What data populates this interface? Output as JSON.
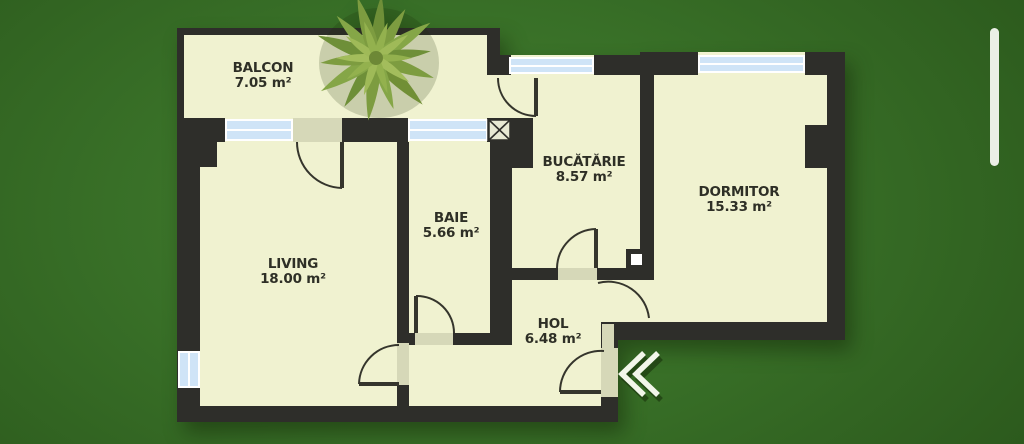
{
  "title": "Apartment floor plan",
  "rooms": {
    "balcon": {
      "name": "BALCON",
      "area": "7.05 m²"
    },
    "living": {
      "name": "LIVING",
      "area": "18.00 m²"
    },
    "baie": {
      "name": "BAIE",
      "area": "5.66 m²"
    },
    "bucatarie": {
      "name": "BUCĂTĂRIE",
      "area": "8.57 m²"
    },
    "dormitor": {
      "name": "DORMITOR",
      "area": "15.33 m²"
    },
    "hol": {
      "name": "HOL",
      "area": "6.48 m²"
    }
  },
  "icons": {
    "entrance-arrow": "double-chevron-left-entrance-marker",
    "plant": "plant-top-view",
    "shaft": "ventilation-shaft-crossed-box"
  },
  "colors": {
    "bg-center": "#448030",
    "bg-mid": "#386f27",
    "bg-edge": "#2b581c",
    "wall": "#2e2e2a",
    "floor": "#f0f2d0",
    "glass": "#cfe4f7",
    "frame": "#ffffff",
    "threshold": "#d6d8b8",
    "label": "#2e2f26",
    "chevron": "#f2f6ea",
    "scrollbar": "#f2f5ee"
  }
}
